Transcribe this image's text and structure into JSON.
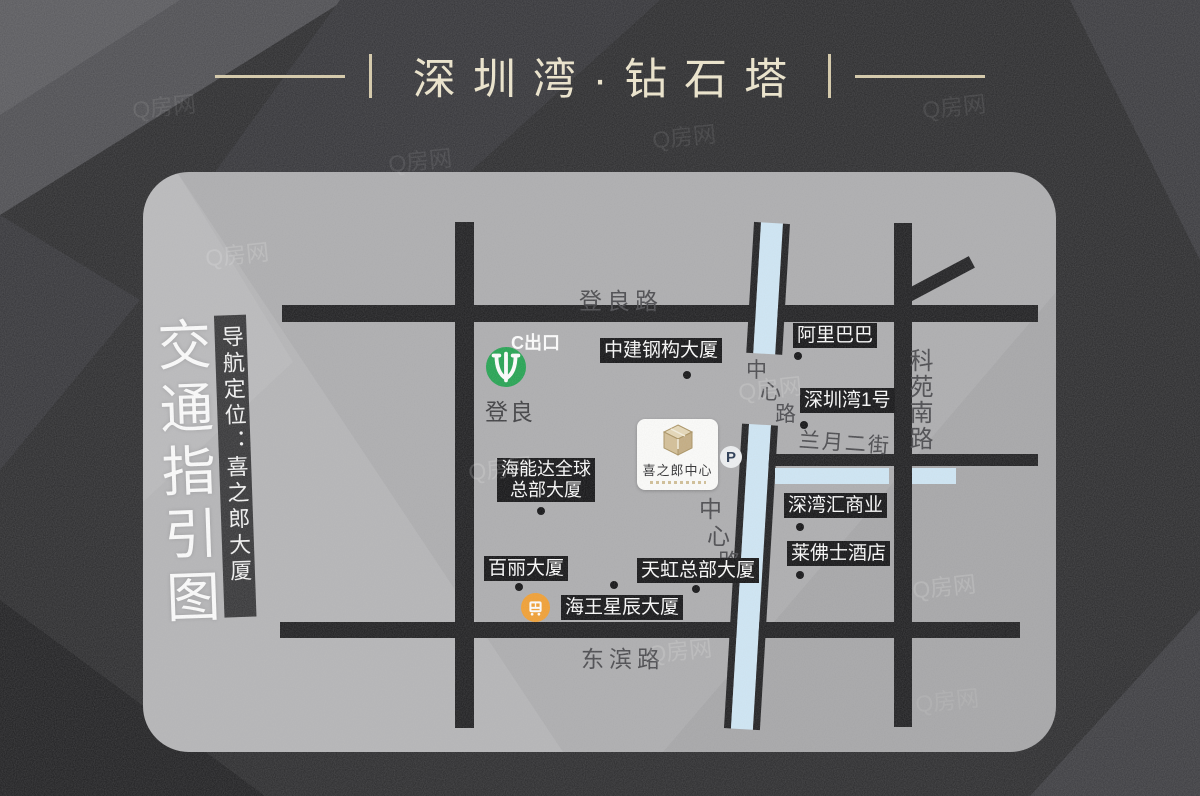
{
  "header": {
    "title": "深圳湾·钻石塔"
  },
  "left_panel": {
    "main_title": "交通指引图",
    "sub_title": "导航定位：喜之郎大厦"
  },
  "map": {
    "road_labels": {
      "dengliang_road": "登良路",
      "dongbin_road": "东滨路",
      "keyuan_south_road": "科苑南路",
      "lanyue_second_street": "兰月二街",
      "center_road_chars": [
        "中",
        "心",
        "路"
      ]
    },
    "metro": {
      "exit": "C出口",
      "station": "登良"
    },
    "landmarks": {
      "zhongjian": "中建钢构大厦",
      "alibaba": "阿里巴巴",
      "shenzhenwan1": "深圳湾1号",
      "hainengda_line1": "海能达全球",
      "hainengda_line2": "总部大厦",
      "baili": "百丽大厦",
      "tianhong": "天虹总部大厦",
      "haiwang": "海王星辰大厦",
      "shenwanhui": "深湾汇商业",
      "laifushi": "莱佛士酒店"
    },
    "project": {
      "name": "喜之郎中心",
      "parking": "P"
    },
    "icons": {
      "metro": "shenzhen-metro-logo",
      "bus": "bus-icon",
      "parking": "parking-icon",
      "project_logo": "gold-cube-logo"
    }
  },
  "watermark": {
    "text": "Q房网"
  },
  "colors": {
    "accent_gold": "#d6caa8",
    "title_text": "#eee6cc",
    "card_gray": "#acacae",
    "road_black": "#1b1b1d",
    "blue_road": "#cfe7f6",
    "metro_green": "#1fa24e",
    "bus_orange": "#f29e2e",
    "label_bg": "#0f0f11"
  }
}
